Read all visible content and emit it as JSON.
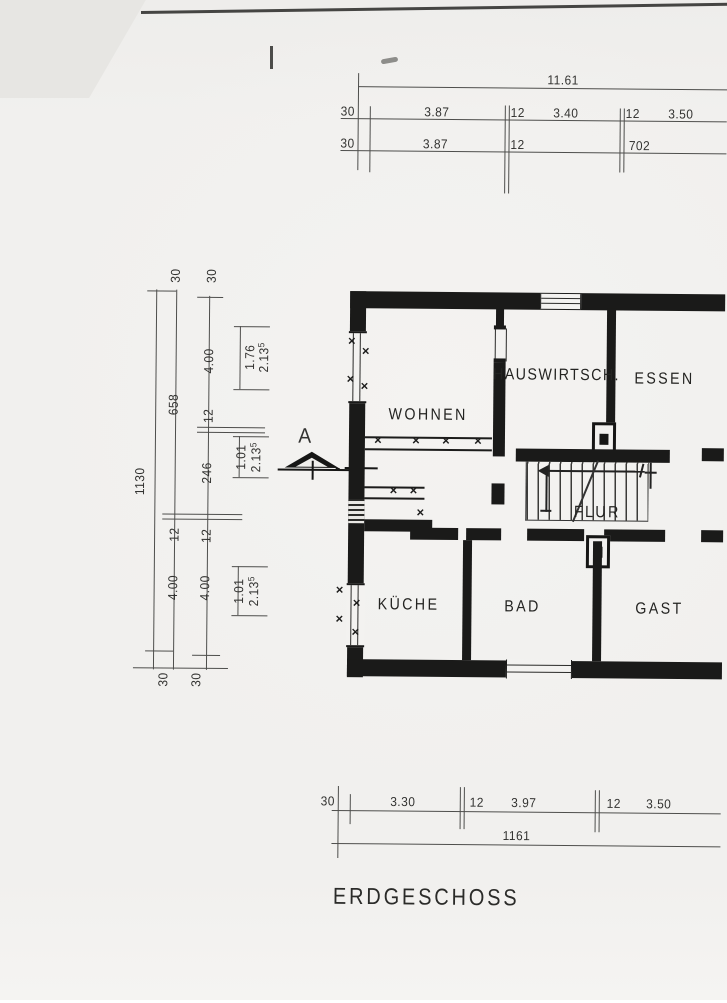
{
  "sheet": {
    "title": "ERDGESCHOSS",
    "section_marker": "A",
    "glyph_x": "×",
    "rooms": {
      "wohnen": "WOHNEN",
      "hausw": "HAUSWIRTSCH.",
      "essen": "ESSEN",
      "flur": "FLUR",
      "kueche": "KÜCHE",
      "bad": "BAD",
      "gast": "GAST"
    },
    "dims": {
      "top_overall": "11.61",
      "top_r2": [
        "30",
        "3.87",
        "12",
        "3.40",
        "12",
        "3.50"
      ],
      "top_r3": [
        "30",
        "3.87",
        "12",
        "702"
      ],
      "bot_r1": [
        "30",
        "3.30",
        "12",
        "3.97",
        "12",
        "3.50"
      ],
      "bot_overall": "1161",
      "left_overall": "1130",
      "left_c2": [
        "30",
        "658",
        "12",
        "4.00",
        "30"
      ],
      "left_c3": [
        "30",
        "4.00",
        "12",
        "246",
        "12",
        "4.00",
        "30"
      ],
      "left_win": [
        {
          "w": "1.76",
          "h": "2.13",
          "s": "5"
        },
        {
          "w": "1.01",
          "h": "2.13",
          "s": "5"
        },
        {
          "w": "1.01",
          "h": "2.13",
          "s": "5"
        }
      ]
    }
  }
}
